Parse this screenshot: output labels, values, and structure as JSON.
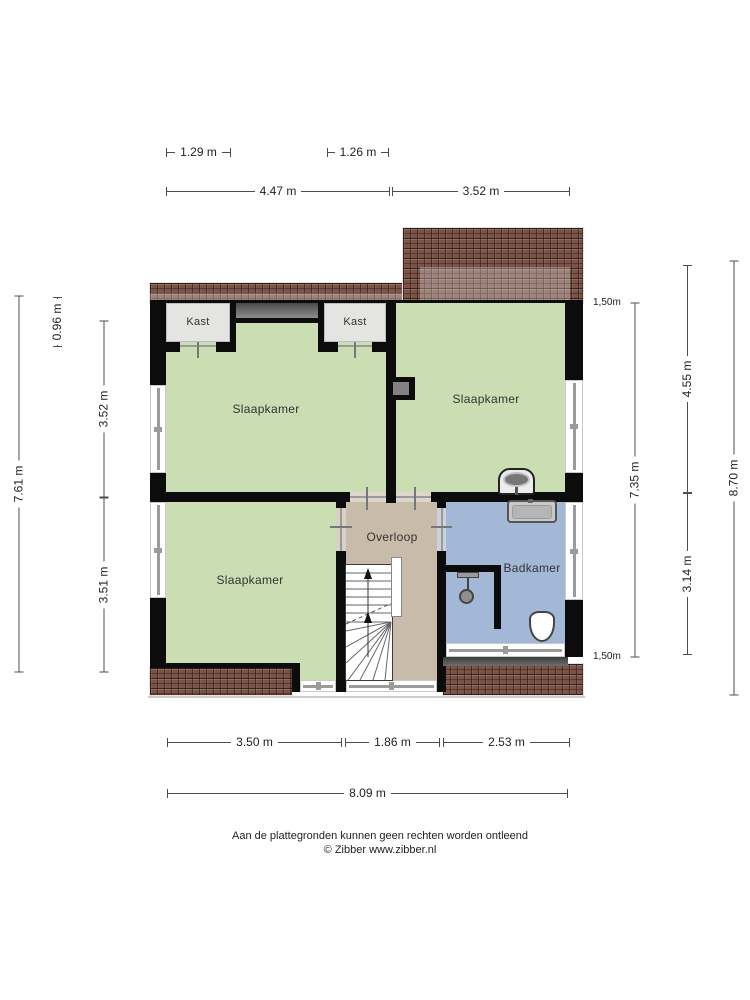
{
  "rooms": [
    {
      "label": "Kast"
    },
    {
      "label": "Kast"
    },
    {
      "label": "Slaapkamer"
    },
    {
      "label": "Slaapkamer"
    },
    {
      "label": "Slaapkamer"
    },
    {
      "label": "Overloop"
    },
    {
      "label": "Badkamer"
    }
  ],
  "dimensions": {
    "top_segment": [
      "1.29 m",
      "1.26 m"
    ],
    "top": [
      "4.47 m",
      "3.52 m"
    ],
    "left": [
      "0.96 m",
      "3.52 m",
      "3.51 m"
    ],
    "left_total": "7.61 m",
    "right": [
      "4.55 m",
      "3.14 m"
    ],
    "right_inner": "7.35 m",
    "right_total": "8.70 m",
    "height_markers": [
      "1,50m",
      "1,50m"
    ],
    "bottom": [
      "3.50 m",
      "1.86 m",
      "2.53 m"
    ],
    "bottom_total": "8.09 m"
  },
  "fixtures": [
    "sink",
    "sink",
    "shower",
    "toilet"
  ],
  "footer": {
    "disclaimer": "Aan de plattegronden kunnen geen rechten worden ontleend",
    "copyright": "© Zibber www.zibber.nl"
  },
  "colors": {
    "bedroom_green": "#cbdeb3",
    "landing_beige": "#c8bba9",
    "bathroom_blue": "#a3b8d6",
    "closet_grey": "#e4e4e3",
    "roof_brown": "#7b5346",
    "wall_black": "#0c0c0c",
    "dormer_grey": "#5a5a5a"
  }
}
